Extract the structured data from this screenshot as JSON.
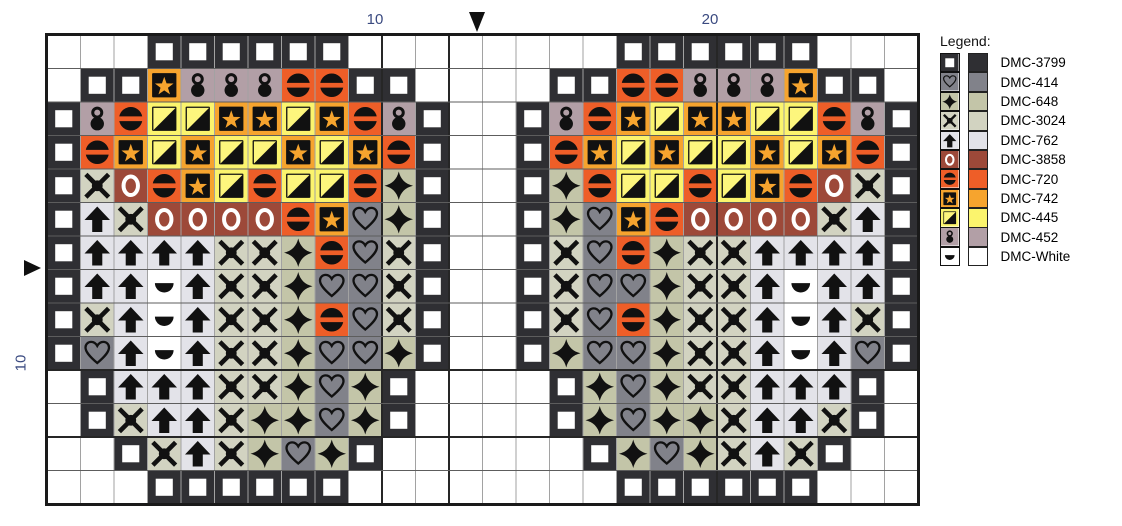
{
  "chart": {
    "cols": 26,
    "rows": 14,
    "cell_px": 33.5,
    "origin_px": {
      "left": 45,
      "top": 33
    },
    "center_col": 13,
    "center_row": 7,
    "bold_grid_cols": [
      10,
      12,
      20
    ],
    "bold_grid_rows": [
      10,
      12
    ],
    "cells": [
      "...QQQQQQ........QQQQQQ...",
      ".QQS888BBQQ....QQBB888SQQ.",
      "Q8BTTSSTSB8Q..Q8BSTSSTTB8Q",
      "QBSTSTTSTSBQ..QBSTSTTSTSBQ",
      "QXOBSTBTTBDQ..QDBTTBTSBOXQ",
      "QUXOOOOBSHDQ..QDHSBOOOOXUQ",
      "QUUUUXXDBHXQ..QXHBDXXUUUUQ",
      "QUUMUXXDHHXQ..QXHHDXXUMUUQ",
      "QXUMUXXDBHXQ..QXHBDXXUMUXQ",
      "QHUMUXXDHHDQ..QDHHDXXUMUHQ",
      ".QUUUXXDHDQ....QDHDXXUUUQ.",
      ".QXUUXDDHDQ....QDHDDXUUXQ.",
      "..QXUXDHDQ......QDHDXUXQ..",
      "...QQQQQQ........QQQQQQ..."
    ]
  },
  "palette": {
    "Q": {
      "symbol": "open-square",
      "color": "#2f2f33"
    },
    "H": {
      "symbol": "heart-outline",
      "color": "#81828a"
    },
    "D": {
      "symbol": "four-point-star",
      "color": "#c3c5a8"
    },
    "X": {
      "symbol": "cross-x",
      "color": "#d2d3c1"
    },
    "U": {
      "symbol": "arrow-up",
      "color": "#e3e3e9"
    },
    "O": {
      "symbol": "letter-o",
      "color": "#9d4939"
    },
    "B": {
      "symbol": "circle-bar",
      "color": "#ee5e28"
    },
    "S": {
      "symbol": "boxed-star",
      "color": "#f6a42e"
    },
    "T": {
      "symbol": "diagonal-square",
      "color": "#fbf46d"
    },
    "8": {
      "symbol": "double-dot",
      "color": "#b29fa6"
    },
    "M": {
      "symbol": "half-moon",
      "color": "#ffffff"
    }
  },
  "legend": {
    "title": "Legend:",
    "entries": [
      {
        "code": "Q",
        "label": "DMC-3799"
      },
      {
        "code": "H",
        "label": "DMC-414"
      },
      {
        "code": "D",
        "label": "DMC-648"
      },
      {
        "code": "X",
        "label": "DMC-3024"
      },
      {
        "code": "U",
        "label": "DMC-762"
      },
      {
        "code": "O",
        "label": "DMC-3858"
      },
      {
        "code": "B",
        "label": "DMC-720"
      },
      {
        "code": "S",
        "label": "DMC-742"
      },
      {
        "code": "T",
        "label": "DMC-445"
      },
      {
        "code": "8",
        "label": "DMC-452"
      },
      {
        "code": "M",
        "label": "DMC-White"
      }
    ]
  },
  "rulers": {
    "top": [
      {
        "label": "10",
        "grid_line": 10
      },
      {
        "label": "20",
        "grid_line": 20
      }
    ],
    "left": [
      {
        "label": "10",
        "grid_line": 10
      }
    ]
  },
  "grid_style": {
    "v_line": "#a2a2a2",
    "h_line": "#5d5d5d",
    "bold_line": "#262626",
    "border": "#1a1a1a",
    "symbol_ink": "#111111",
    "star_gold": "#f6a42e",
    "triangle_yellow": "#fdf67d"
  }
}
